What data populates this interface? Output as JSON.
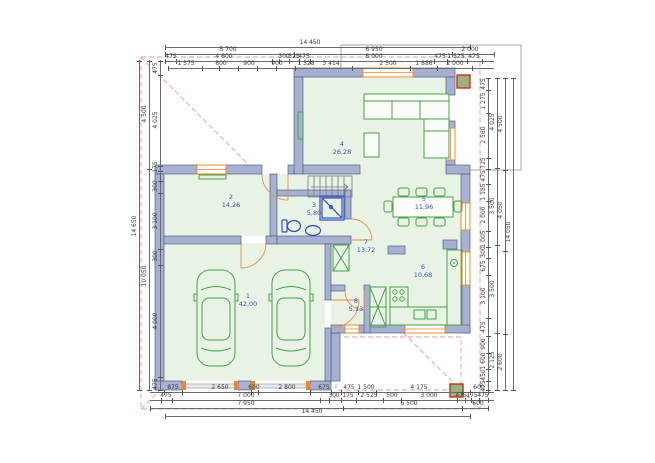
{
  "title": "Ground floor plan drawing",
  "colors": {
    "wall": "#a6b0d0",
    "wall_stroke": "#566084",
    "floor": "#e8f3e5",
    "furniture_green": "#44a344",
    "sanitary_blue": "#2d50cc",
    "window_orange": "#ef8824",
    "room_label_blue": "#3950c8",
    "dimension_text": "#3a3a3a",
    "roof_dash_pink": "#e59a9a",
    "column_fill": "#9db07e",
    "column_stroke": "#c5301f",
    "reference_outline": "#9b9b9b"
  },
  "rooms": [
    {
      "number": "1",
      "area": "42,00",
      "x": 248,
      "y": 300
    },
    {
      "number": "2",
      "area": "14,26",
      "x": 231,
      "y": 201
    },
    {
      "number": "3",
      "area": "5,80",
      "x": 314,
      "y": 209
    },
    {
      "number": "4",
      "area": "26,28",
      "x": 342,
      "y": 148
    },
    {
      "number": "5",
      "area": "11,96",
      "x": 424,
      "y": 203
    },
    {
      "number": "6",
      "area": "10,68",
      "x": 423,
      "y": 271
    },
    {
      "number": "7",
      "area": "13,72",
      "x": 366,
      "y": 246
    },
    {
      "number": "8",
      "area": "5,13",
      "x": 356,
      "y": 305
    }
  ],
  "dim_rows": [
    {
      "o": "h",
      "l": 47,
      "a": 165,
      "b": 470,
      "k": [
        165,
        470
      ],
      "L": [
        {
          "t": "14 450",
          "p": 310
        }
      ]
    },
    {
      "o": "h",
      "l": 54,
      "a": 165,
      "b": 494,
      "k": [
        165,
        294,
        452,
        494
      ],
      "L": [
        {
          "t": "5 700",
          "p": 228
        },
        {
          "t": "6 950",
          "p": 374
        },
        {
          "t": "2 000",
          "p": 470
        }
      ]
    },
    {
      "o": "h",
      "l": 61,
      "a": 165,
      "b": 494,
      "k": [
        165,
        176,
        272,
        279,
        289,
        299,
        310,
        434,
        447,
        467,
        482
      ],
      "L": [
        {
          "t": "475",
          "p": 171
        },
        {
          "t": "4 600",
          "p": 224
        },
        {
          "t": "300",
          "p": 284
        },
        {
          "t": "325",
          "p": 294
        },
        {
          "t": "475",
          "p": 304
        },
        {
          "t": "6 000",
          "p": 374
        },
        {
          "t": "475",
          "p": 440
        },
        {
          "t": "1 525",
          "p": 456
        },
        {
          "t": "475",
          "p": 474
        }
      ]
    },
    {
      "o": "h",
      "l": 68,
      "a": 168,
      "b": 494,
      "k": [
        168,
        202,
        219,
        238,
        257,
        276,
        295,
        352,
        410,
        437,
        472
      ],
      "L": [
        {
          "t": "1 575",
          "p": 186
        },
        {
          "t": "800",
          "p": 221
        },
        {
          "t": "900",
          "p": 249
        },
        {
          "t": "900",
          "p": 277
        },
        {
          "t": "1 528",
          "p": 306
        },
        {
          "t": "3 414",
          "p": 331
        },
        {
          "t": "2 500",
          "p": 388
        },
        {
          "t": "1 886",
          "p": 424
        },
        {
          "t": "2 000",
          "p": 455
        }
      ]
    },
    {
      "o": "h",
      "l": 392,
      "a": 150,
      "b": 494,
      "k": [
        164,
        182,
        251,
        258,
        310,
        331,
        341,
        358,
        376,
        462,
        470,
        488
      ],
      "L": [
        {
          "t": "875",
          "p": 173
        },
        {
          "t": "2 650",
          "p": 220
        },
        {
          "t": "600",
          "p": 254
        },
        {
          "t": "2 800",
          "p": 287
        },
        {
          "t": "675",
          "p": 324
        },
        {
          "t": "475",
          "p": 349
        },
        {
          "t": "1 500",
          "p": 366
        },
        {
          "t": "4 175",
          "p": 419
        },
        {
          "t": "600",
          "p": 479
        }
      ]
    },
    {
      "o": "h",
      "l": 400,
      "a": 150,
      "b": 494,
      "k": [
        161,
        172,
        320,
        329,
        341,
        356,
        383,
        401,
        457,
        465,
        471,
        479,
        488
      ],
      "L": [
        {
          "t": "475",
          "p": 166
        },
        {
          "t": "7 000",
          "p": 246
        },
        {
          "t": "300",
          "p": 334
        },
        {
          "t": "175",
          "p": 348
        },
        {
          "t": "2 525",
          "p": 369
        },
        {
          "t": "500",
          "p": 392
        },
        {
          "t": "3 000",
          "p": 429
        },
        {
          "t": "475",
          "p": 461
        },
        {
          "t": "175",
          "p": 472
        },
        {
          "t": "475",
          "p": 483
        }
      ]
    },
    {
      "o": "h",
      "l": 408,
      "a": 150,
      "b": 488,
      "k": [
        150,
        343,
        462,
        488
      ],
      "L": [
        {
          "t": "7 950",
          "p": 246
        },
        {
          "t": "6 500",
          "p": 409
        },
        {
          "t": "600",
          "p": 478
        }
      ]
    },
    {
      "o": "h",
      "l": 416,
      "a": 165,
      "b": 470,
      "k": [
        165,
        470
      ],
      "L": [
        {
          "t": "14 450",
          "p": 312
        }
      ]
    },
    {
      "o": "v",
      "l": 160,
      "a": 60,
      "b": 390,
      "k": [
        61,
        75,
        166,
        171,
        181,
        193,
        249,
        265,
        377,
        390
      ],
      "L": [
        {
          "t": "475",
          "p": 68
        },
        {
          "t": "4 025",
          "p": 120
        },
        {
          "t": "175",
          "p": 167
        },
        {
          "t": "300",
          "p": 186
        },
        {
          "t": "3 100",
          "p": 221
        },
        {
          "t": "300",
          "p": 256
        },
        {
          "t": "4 000",
          "p": 321
        },
        {
          "t": "475",
          "p": 384
        }
      ]
    },
    {
      "o": "v",
      "l": 149,
      "a": 60,
      "b": 390,
      "k": [
        61,
        169,
        390
      ],
      "L": [
        {
          "t": "4 500",
          "p": 114
        },
        {
          "t": "10 050",
          "p": 276
        }
      ]
    },
    {
      "o": "v",
      "l": 139,
      "a": 60,
      "b": 390,
      "k": [
        61,
        390
      ],
      "L": [
        {
          "t": "14 650",
          "p": 226
        }
      ]
    },
    {
      "o": "v",
      "l": 488,
      "a": 78,
      "b": 390,
      "k": [
        78,
        90,
        113,
        158,
        169,
        184,
        201,
        231,
        247,
        258,
        275,
        318,
        336,
        353,
        369,
        381,
        390
      ],
      "L": [
        {
          "t": "475",
          "p": 84
        },
        {
          "t": "1 275",
          "p": 101
        },
        {
          "t": "2 580",
          "p": 135
        },
        {
          "t": "725",
          "p": 163
        },
        {
          "t": "475",
          "p": 176
        },
        {
          "t": "1 185",
          "p": 192
        },
        {
          "t": "2 000",
          "p": 215
        },
        {
          "t": "1 005",
          "p": 239
        },
        {
          "t": "300",
          "p": 252
        },
        {
          "t": "675",
          "p": 266
        },
        {
          "t": "3 100",
          "p": 296
        },
        {
          "t": "475",
          "p": 327
        },
        {
          "t": "900",
          "p": 344
        },
        {
          "t": "1 600",
          "p": 361
        },
        {
          "t": "450",
          "p": 375
        },
        {
          "t": "475",
          "p": 386
        }
      ]
    },
    {
      "o": "v",
      "l": 497,
      "a": 78,
      "b": 390,
      "k": [
        78,
        168,
        245,
        333,
        390
      ],
      "L": [
        {
          "t": "4 025",
          "p": 122
        },
        {
          "t": "3 500",
          "p": 206
        },
        {
          "t": "3 500",
          "p": 289
        },
        {
          "t": "2 125",
          "p": 360
        }
      ]
    },
    {
      "o": "v",
      "l": 505,
      "a": 78,
      "b": 390,
      "k": [
        78,
        170,
        251,
        334,
        390
      ],
      "L": [
        {
          "t": "4 500",
          "p": 124
        },
        {
          "t": "4 050",
          "p": 210
        },
        {
          "t": "2 600",
          "p": 362
        }
      ]
    },
    {
      "o": "v",
      "l": 513,
      "a": 78,
      "b": 390,
      "k": [
        78,
        390
      ],
      "L": [
        {
          "t": "14 050",
          "p": 232
        }
      ]
    }
  ]
}
